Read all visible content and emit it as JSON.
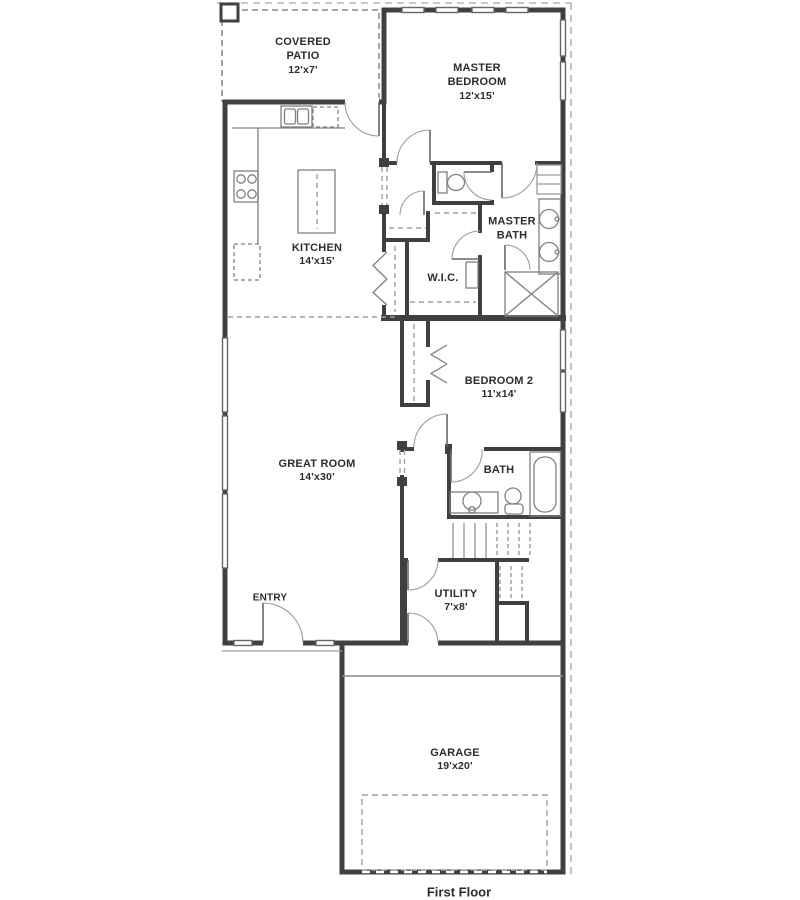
{
  "footer": {
    "label": "First Floor"
  },
  "rooms": [
    {
      "id": "covered-patio",
      "name": "COVERED PATIO",
      "dims": "12'x7'"
    },
    {
      "id": "master-bedroom",
      "name": "MASTER BEDROOM",
      "dims": "12'x15'"
    },
    {
      "id": "kitchen",
      "name": "KITCHEN",
      "dims": "14'x15'"
    },
    {
      "id": "master-bath",
      "name": "MASTER BATH",
      "dims": ""
    },
    {
      "id": "wic",
      "name": "W.I.C.",
      "dims": ""
    },
    {
      "id": "bedroom-2",
      "name": "BEDROOM 2",
      "dims": "11'x14'"
    },
    {
      "id": "great-room",
      "name": "GREAT ROOM",
      "dims": "14'x30'"
    },
    {
      "id": "bath",
      "name": "BATH",
      "dims": ""
    },
    {
      "id": "entry",
      "name": "ENTRY",
      "dims": ""
    },
    {
      "id": "utility",
      "name": "UTILITY",
      "dims": "7'x8'"
    },
    {
      "id": "garage",
      "name": "GARAGE",
      "dims": "19'x20'"
    }
  ],
  "colors": {
    "wall": "#404040",
    "fixture": "#808080",
    "dashed": "#a0a0a0",
    "text": "#2d2d2d"
  }
}
